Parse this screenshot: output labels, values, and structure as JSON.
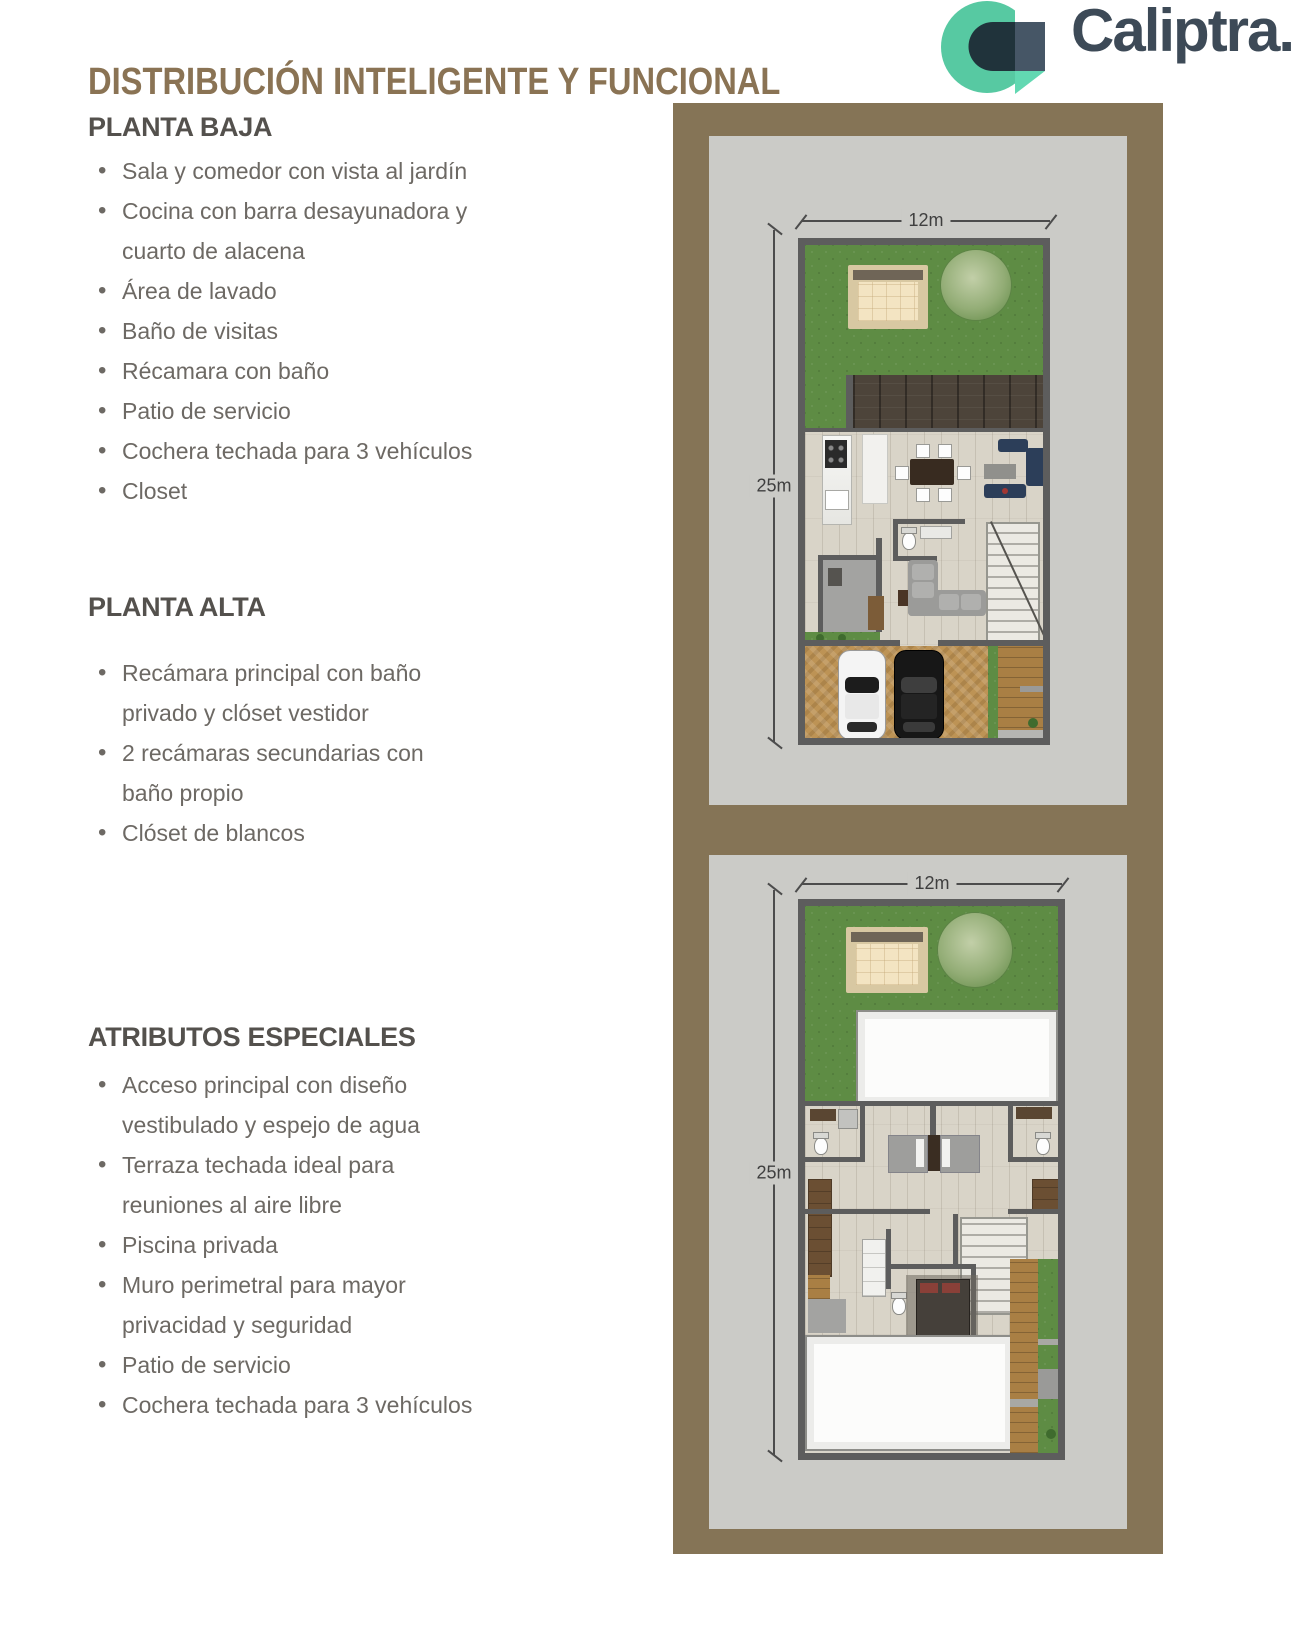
{
  "header": {
    "title": "DISTRIBUCIÓN INTELIGENTE Y FUNCIONAL",
    "logo": {
      "icon": "caliptra-c-icon",
      "wordmark": "Caliptra."
    }
  },
  "sections": [
    {
      "heading": "PLANTA BAJA",
      "items": [
        "Sala y comedor con vista al jardín",
        "Cocina con barra desayunadora y\ncuarto de alacena",
        "Área de lavado",
        "Baño de visitas",
        "Récamara con baño",
        "Patio de servicio",
        "Cochera techada para 3 vehículos",
        "Closet"
      ]
    },
    {
      "heading": "PLANTA ALTA",
      "items": [
        "Recámara principal con baño\nprivado y clóset vestidor",
        "2 recámaras secundarias con\nbaño propio",
        "Clóset de blancos"
      ]
    },
    {
      "heading": "ATRIBUTOS ESPECIALES",
      "items": [
        "Acceso principal con diseño\nvestibulado y espejo de agua",
        "Terraza techada ideal para\nreuniones al aire libre",
        "Piscina privada",
        "Muro perimetral para mayor\nprivacidad y seguridad",
        "Patio de servicio",
        "Cochera techada para 3 vehículos"
      ]
    }
  ],
  "plans": [
    {
      "name": "planta-baja",
      "width_label": "12m",
      "height_label": "25m"
    },
    {
      "name": "planta-alta",
      "width_label": "12m",
      "height_label": "25m"
    }
  ],
  "colors": {
    "title_gold": "#8a7354",
    "frame_brown": "#857456",
    "panel_gray": "#cbcbc7",
    "wall_gray": "#5d5d5d",
    "grass_green": "#5e8c44",
    "driveway_tan": "#bd9355",
    "logo_mint": "#57c9a2",
    "logo_mint_light": "#62d8b2",
    "logo_slate": "#3d4a57",
    "text_gray": "#6d6964"
  }
}
